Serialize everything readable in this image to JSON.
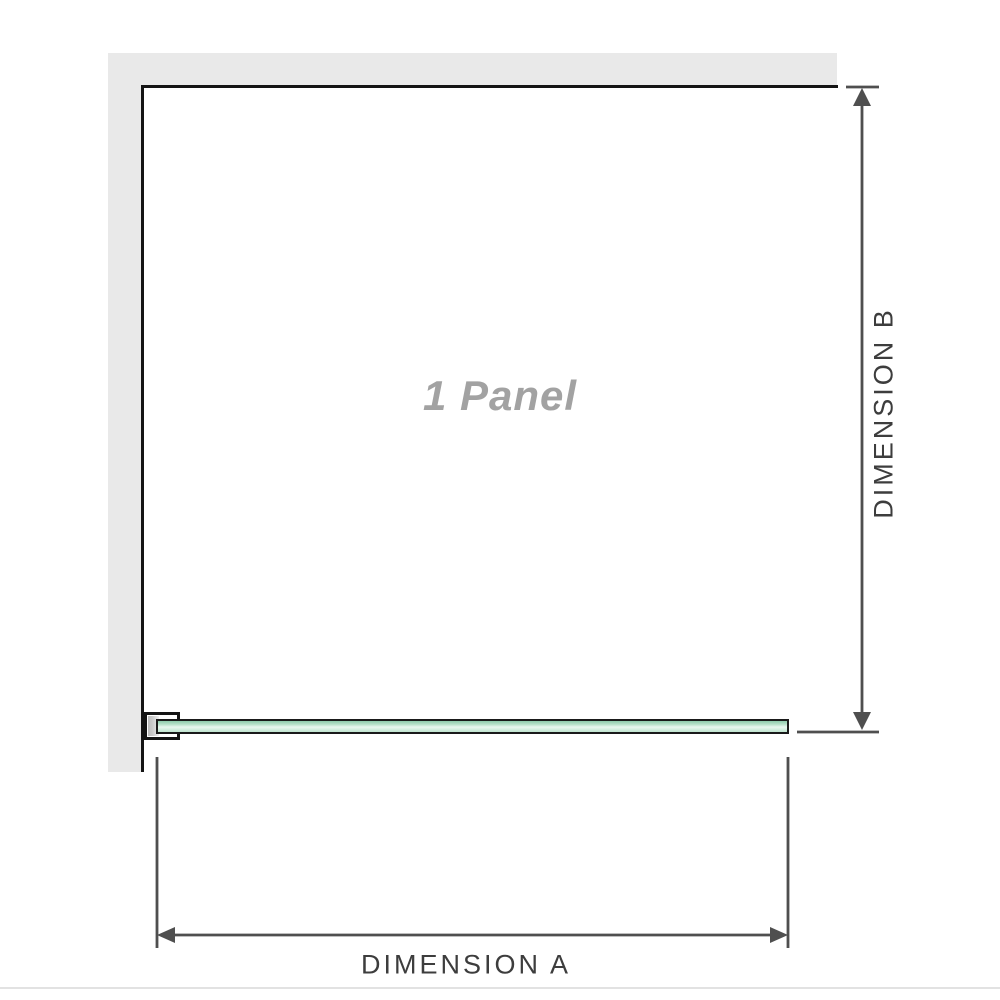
{
  "diagram": {
    "panel_label": "1 Panel",
    "dimension_a_label": "DIMENSION A",
    "dimension_b_label": "DIMENSION B"
  },
  "colors": {
    "wall": "#e9e9e9",
    "wall_edge": "#141414",
    "glass_border": "#1a1a1a",
    "glass_top": "#8ecbab",
    "glass_mid": "#eaf7f0",
    "glass_bottom": "#bfe4cf",
    "bracket_metal": "#c9c9c9",
    "dimension_line": "#4f4f4f",
    "dimension_text": "#3d3d3d",
    "panel_text": "#a2a2a2",
    "baseline_rule": "#e2e2e2"
  }
}
